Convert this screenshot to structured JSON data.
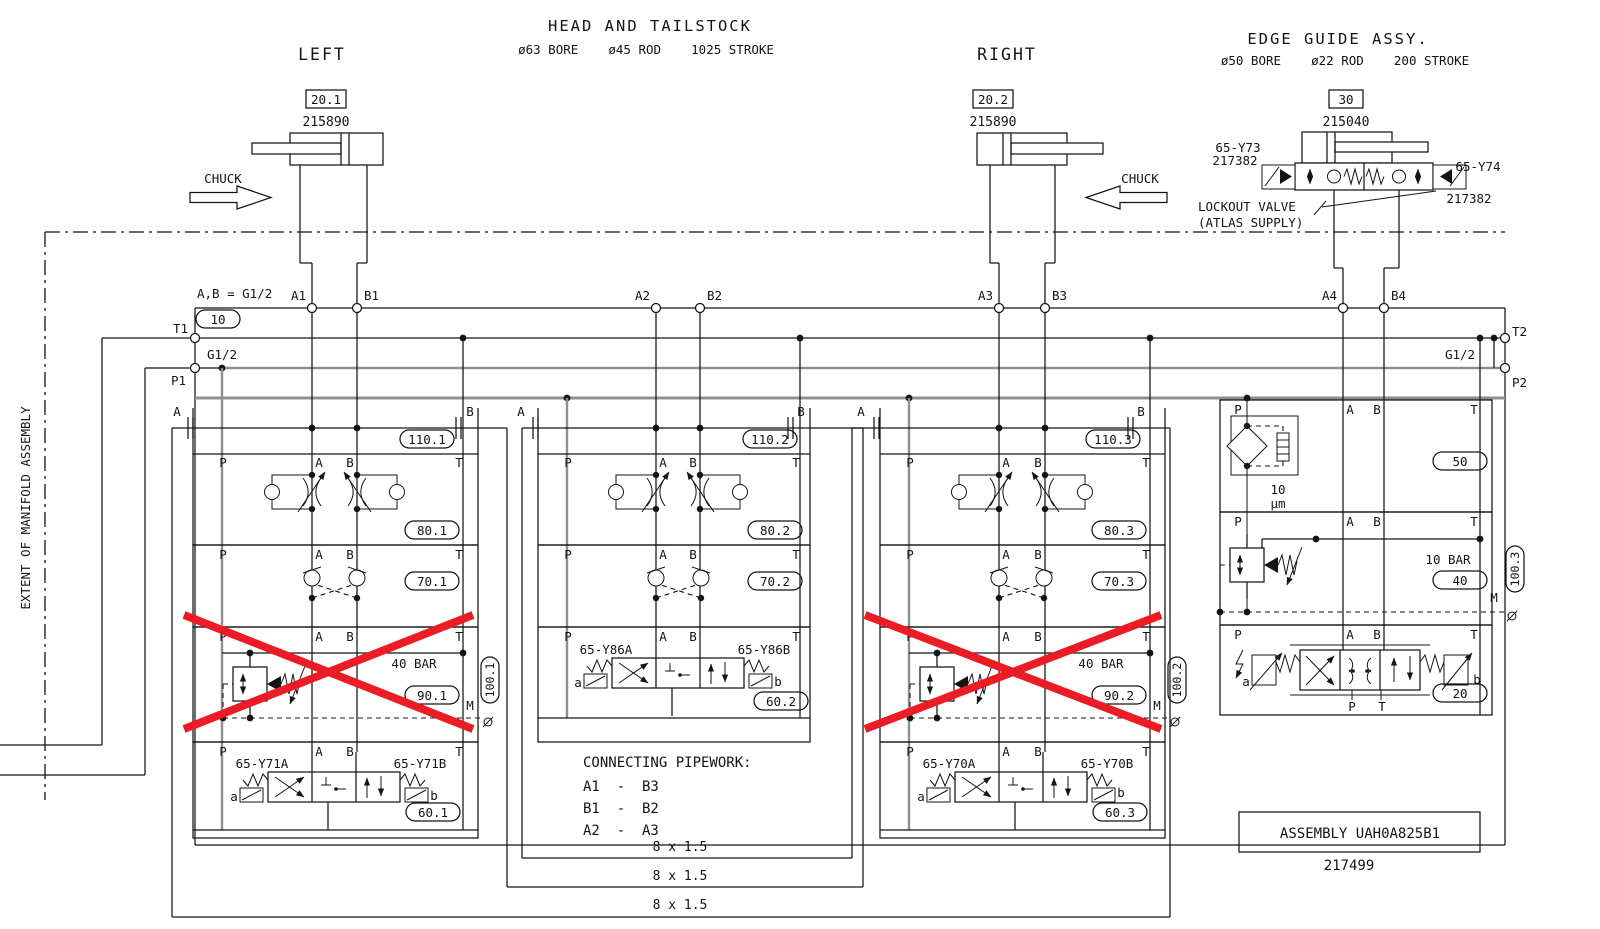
{
  "titles": {
    "main": "HEAD AND TAILSTOCK",
    "main_spec": "ø63 BORE    ø45 ROD    1025 STROKE",
    "left": "LEFT",
    "right": "RIGHT",
    "edge": "EDGE GUIDE ASSY.",
    "edge_spec": "ø50 BORE    ø22 ROD    200 STROKE",
    "extent": "EXTENT OF MANIFOLD ASSEMBLY"
  },
  "cylinders": {
    "left_tag": "20.1",
    "left_part": "215890",
    "left_chuck": "CHUCK",
    "right_tag": "20.2",
    "right_part": "215890",
    "right_chuck": "CHUCK",
    "edge_tag": "30",
    "edge_part": "215040"
  },
  "lockout": {
    "sol_left": "65-Y73",
    "sol_left_part": "217382",
    "sol_right": "65-Y74",
    "sol_right_part": "217382",
    "note1": "LOCKOUT VALVE",
    "note2": "(ATLAS SUPPLY)"
  },
  "manifold": {
    "ab_note": "A,B = G1/2",
    "block_tag": "10",
    "t1": "T1",
    "p1": "P1",
    "t2": "T2",
    "p2": "P2",
    "g12_left": "G1/2",
    "g12_right": "G1/2",
    "ports": {
      "a1": "A1",
      "b1": "B1",
      "a2": "A2",
      "b2": "B2",
      "a3": "A3",
      "b3": "B3",
      "a4": "A4",
      "b4": "B4"
    },
    "lbl": {
      "p": "P",
      "a": "A",
      "b": "B",
      "t": "T",
      "m": "M",
      "va": "a",
      "vb": "b"
    }
  },
  "sections": [
    {
      "tag110": "110.1",
      "tag80": "80.1",
      "tag70": "70.1",
      "tag90": "90.1",
      "press": "40 BAR",
      "tag100": "100.1",
      "tag60": "60.1",
      "solA": "65-Y71A",
      "solB": "65-Y71B"
    },
    {
      "tag110": "110.2",
      "tag80": "80.2",
      "tag70": "70.2",
      "tag60": "60.2",
      "solA": "65-Y86A",
      "solB": "65-Y86B"
    },
    {
      "tag110": "110.3",
      "tag80": "80.3",
      "tag70": "70.3",
      "tag90": "90.2",
      "press": "40 BAR",
      "tag100": "100.2",
      "tag60": "60.3",
      "solA": "65-Y70A",
      "solB": "65-Y70B"
    }
  ],
  "edge_section": {
    "tag50": "50",
    "filter1": "10",
    "filter2": "µm",
    "tag40": "40",
    "press": "10 BAR",
    "tag100": "100.3",
    "tag20": "20",
    "p": "P",
    "t": "T"
  },
  "pipework": {
    "title": "CONNECTING PIPEWORK:",
    "l1": "A1  -  B3",
    "l2": "B1  -  B2",
    "l3": "A2  -  A3",
    "size1": "8 x 1.5",
    "size2": "8 x 1.5",
    "size3": "8 x 1.5"
  },
  "assembly": {
    "label": "ASSEMBLY UAH0A825B1",
    "number": "217499"
  },
  "colors": {
    "line": "#141414",
    "rail_gray": "#8f8f8f",
    "cross_red": "#ec1c24"
  }
}
